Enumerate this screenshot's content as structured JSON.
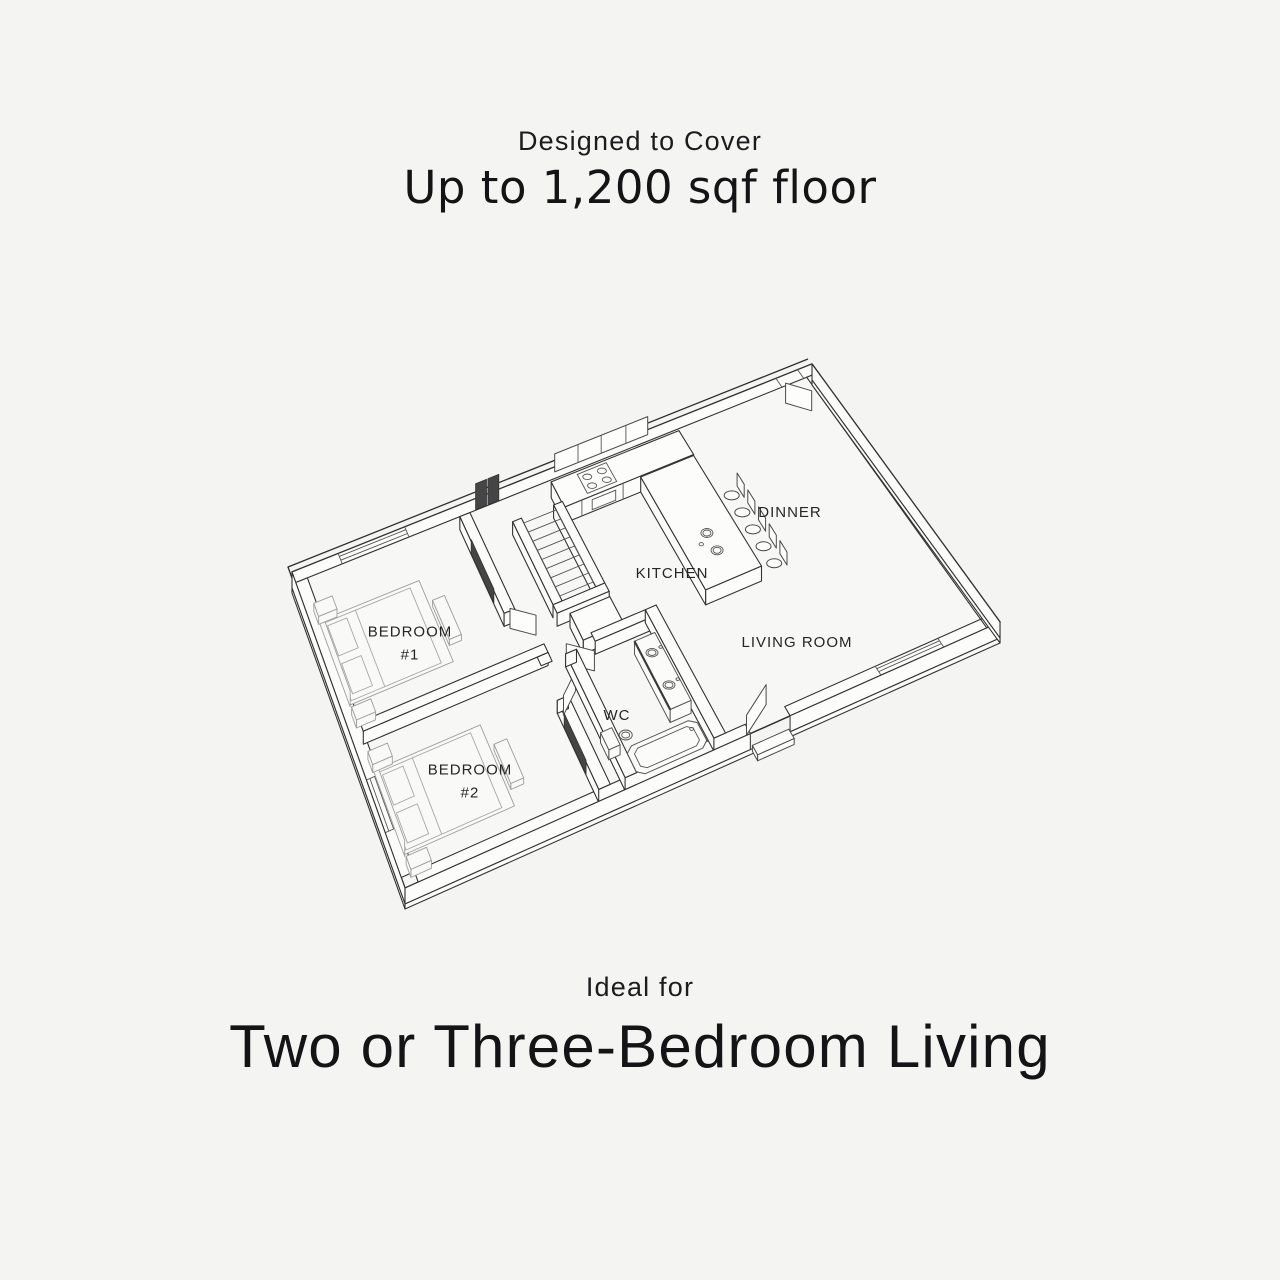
{
  "colors": {
    "background": "#f4f4f2",
    "line": "#2e2e2e",
    "text": "#1d1d1f"
  },
  "header": {
    "eyebrow": "Designed to Cover",
    "title": "Up to 1,200 sqf floor"
  },
  "footer": {
    "eyebrow": "Ideal for",
    "title": "Two or Three-Bedroom Living"
  },
  "floor_plan": {
    "rooms": [
      {
        "id": "dinner",
        "label": "DINNER",
        "sub": ""
      },
      {
        "id": "kitchen",
        "label": "KITCHEN",
        "sub": ""
      },
      {
        "id": "living",
        "label": "LIVING ROOM",
        "sub": ""
      },
      {
        "id": "wc",
        "label": "WC",
        "sub": ""
      },
      {
        "id": "bedroom-1",
        "label": "BEDROOM",
        "sub": "#1"
      },
      {
        "id": "bedroom-2",
        "label": "BEDROOM",
        "sub": "#2"
      }
    ]
  }
}
